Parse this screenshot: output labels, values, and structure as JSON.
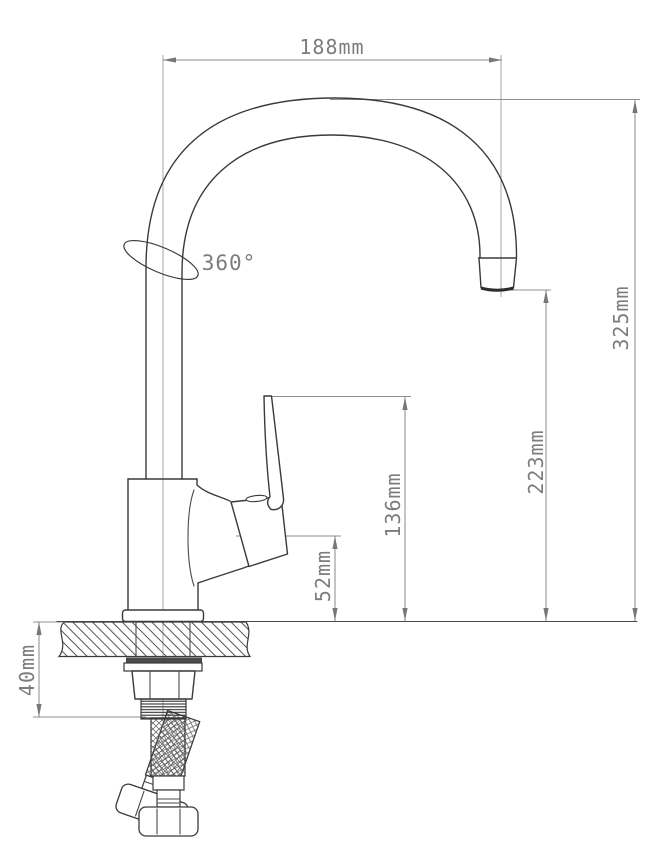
{
  "colors": {
    "geometry_line": "#3a3a3a",
    "dimension_line": "#8a8a8a",
    "dimension_text": "#7c7c7c",
    "background": "#ffffff"
  },
  "annotations": {
    "swivel": "360°"
  },
  "dimensions": {
    "spout_reach": "188mm",
    "total_height": "325mm",
    "outlet_height": "223mm",
    "handle_top_height": "136mm",
    "valve_center_height": "52mm",
    "mounting_depth": "40mm"
  }
}
